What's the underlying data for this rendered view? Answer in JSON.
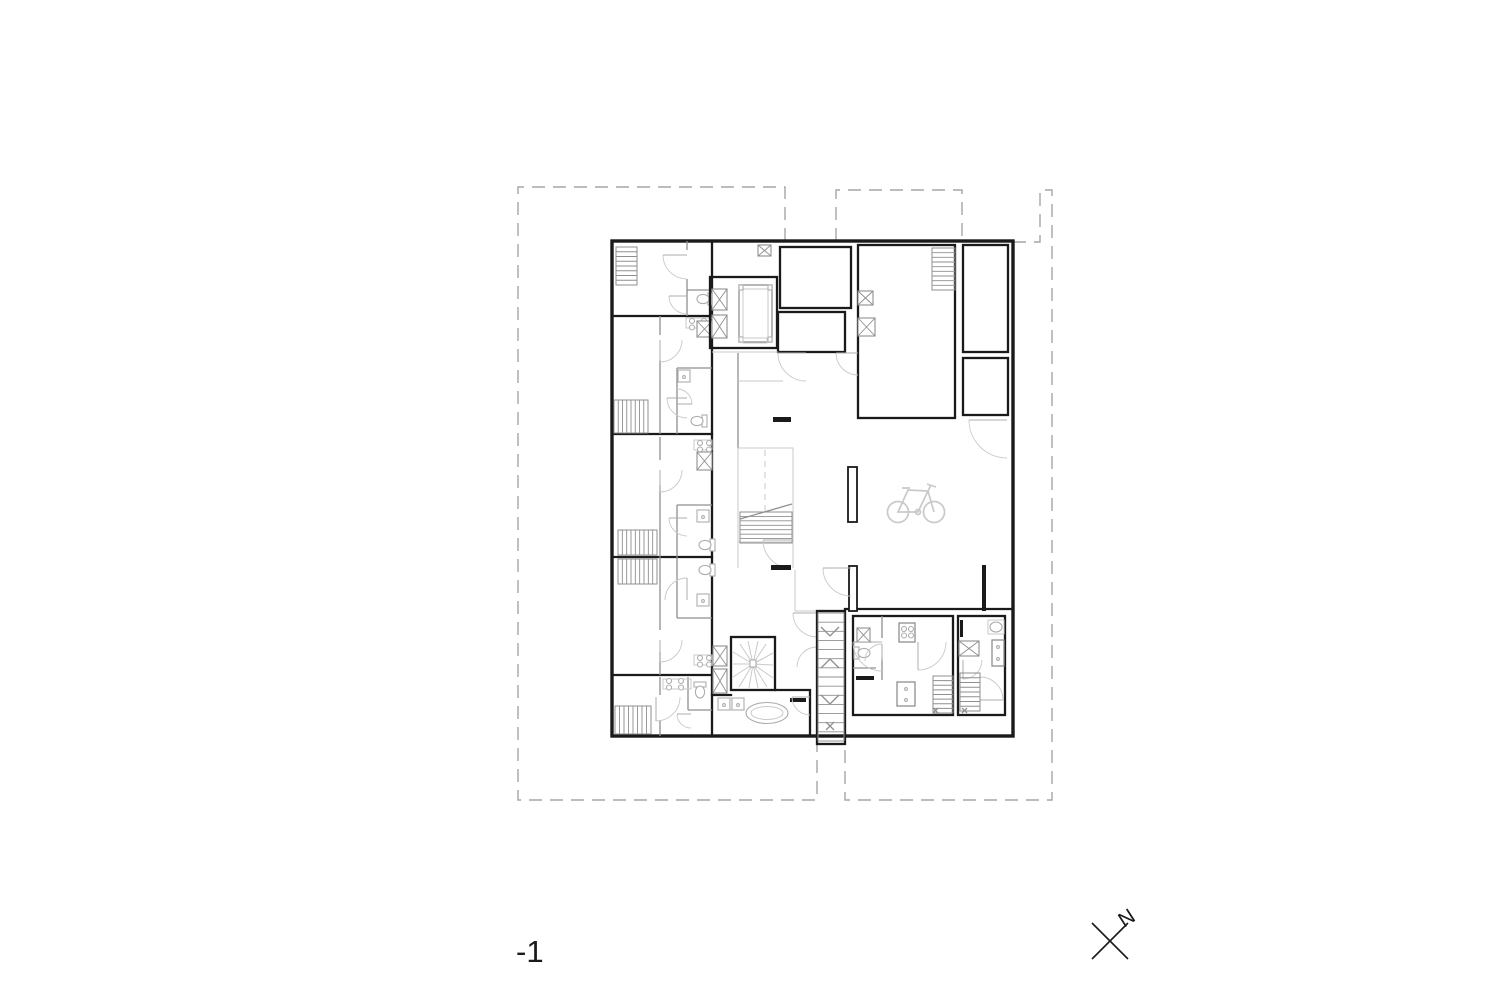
{
  "page": {
    "background": "#ffffff"
  },
  "plan": {
    "floor_label": "-1",
    "north_label": "N",
    "colors": {
      "wall": "#1a1a1a",
      "partition": "#8f8f8f",
      "fixture": "#adadad",
      "light": "#c9c9c9",
      "dash": "#a6a6a6",
      "text": "#1a1a1a"
    }
  }
}
